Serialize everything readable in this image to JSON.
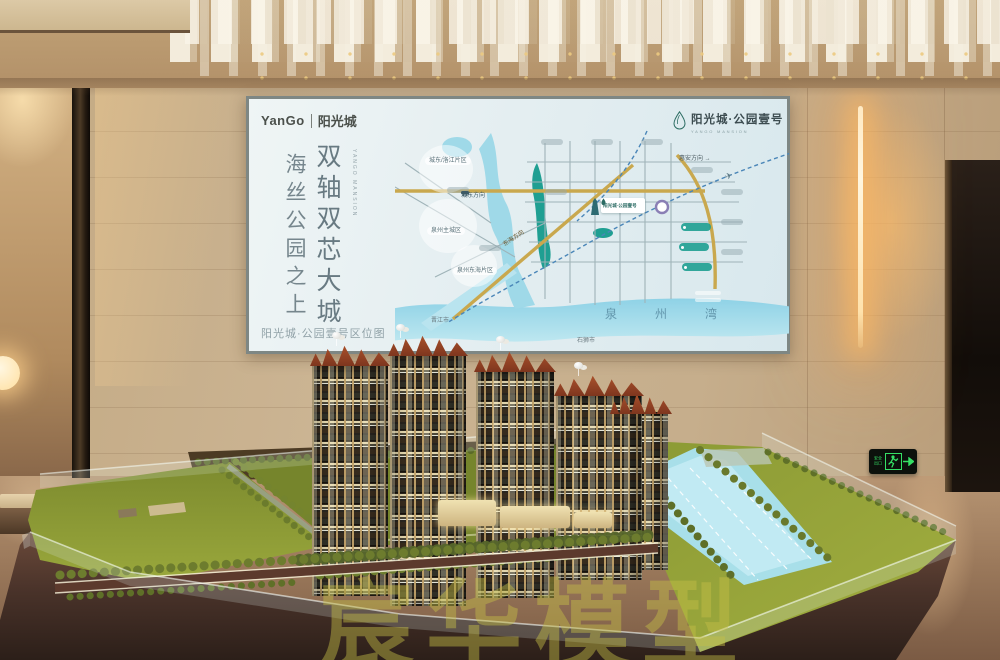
{
  "billboard": {
    "brand": {
      "latin": "YanGo",
      "cn": "阳光城"
    },
    "headline": {
      "primary": "双轴双芯大城",
      "secondary": "海丝公园之上",
      "latin": "YANGO MANSION"
    },
    "project_logo": {
      "cn": "阳光城·公园壹号",
      "en": "YANGO MANSION"
    },
    "caption": "阳光城·公园壹号区位图",
    "map": {
      "bay": "泉州湾",
      "districts": [
        "城东/洛江片区",
        "泉州主城区",
        "泉州东海片区"
      ],
      "cities": [
        "晋江市",
        "石狮市"
      ],
      "directions": {
        "chengdong": "城东方向",
        "donghai": "东海方向",
        "huian": "惠安方向 →"
      },
      "marker": "阳光城·公园壹号",
      "plane_icon": "✈"
    }
  },
  "signage": {
    "exit": "安全出口"
  },
  "watermark": "宸华模型",
  "colors": {
    "map_park_teal": "#1f9f92",
    "map_road_gold": "#c9a84e",
    "exit_green": "#35e065",
    "lamp_glow": "#ffc07a",
    "lawn_green": "#8f9c35",
    "roof_terracotta": "#a84d2c"
  }
}
